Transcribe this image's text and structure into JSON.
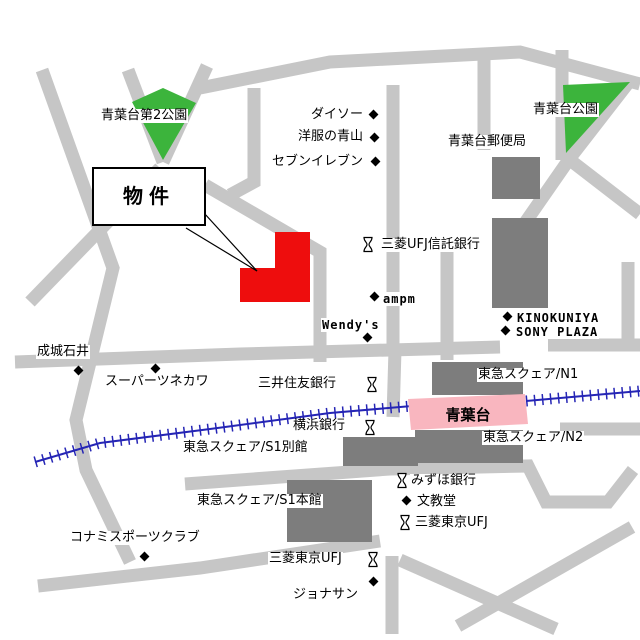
{
  "colors": {
    "road": "#c6c6c6",
    "building": "#7d7d7d",
    "park": "#3cb43c",
    "property_red": "#ee0d0d",
    "station_pink": "#f9b6bf",
    "railway_blue": "#2525b5",
    "outline": "#000000",
    "label_bg": "#ffffff"
  },
  "callout": {
    "label": "物件"
  },
  "station": {
    "name": "青葉台"
  },
  "labels": [
    {
      "id": "aobadai-dai2-park",
      "text": "青葉台第2公園"
    },
    {
      "id": "daiso",
      "text": "ダイソー"
    },
    {
      "id": "yofuku-no-aoyama",
      "text": "洋服の青山"
    },
    {
      "id": "seven-eleven",
      "text": "セブンイレブン"
    },
    {
      "id": "aobadai-park",
      "text": "青葉台公園"
    },
    {
      "id": "aobadai-post-office",
      "text": "青葉台郵便局"
    },
    {
      "id": "mitsubishi-ufj-trust-bank",
      "text": "三菱UFJ信託銀行"
    },
    {
      "id": "ampm",
      "text": "ampm"
    },
    {
      "id": "wendys",
      "text": "Wendy's"
    },
    {
      "id": "kinokuniya",
      "text": "KINOKUNIYA"
    },
    {
      "id": "sony-plaza",
      "text": "SONY PLAZA"
    },
    {
      "id": "seijo-ishii",
      "text": "成城石井"
    },
    {
      "id": "super-tsunekawa",
      "text": "スーパーツネカワ"
    },
    {
      "id": "mitsui-sumitomo-bank",
      "text": "三井住友銀行"
    },
    {
      "id": "tokyu-square-n1",
      "text": "東急スクェア/N1"
    },
    {
      "id": "yokohama-bank",
      "text": "横浜銀行"
    },
    {
      "id": "tokyu-square-n2",
      "text": "東急スクェア/N2"
    },
    {
      "id": "tokyu-square-s1-annex",
      "text": "東急スクェア/S1別館"
    },
    {
      "id": "tokyu-square-s1-main",
      "text": "東急スクェア/S1本館"
    },
    {
      "id": "mizuho-bank",
      "text": "みずほ銀行"
    },
    {
      "id": "bunkyodo",
      "text": "文教堂"
    },
    {
      "id": "mitsubishi-tokyo-ufj",
      "text": "三菱東京UFJ"
    },
    {
      "id": "konami-sports-club",
      "text": "コナミスポーツクラブ"
    },
    {
      "id": "mitsubishi-tokyo-ufj-2",
      "text": "三菱東京UFJ"
    },
    {
      "id": "jonathan",
      "text": "ジョナサン"
    }
  ]
}
